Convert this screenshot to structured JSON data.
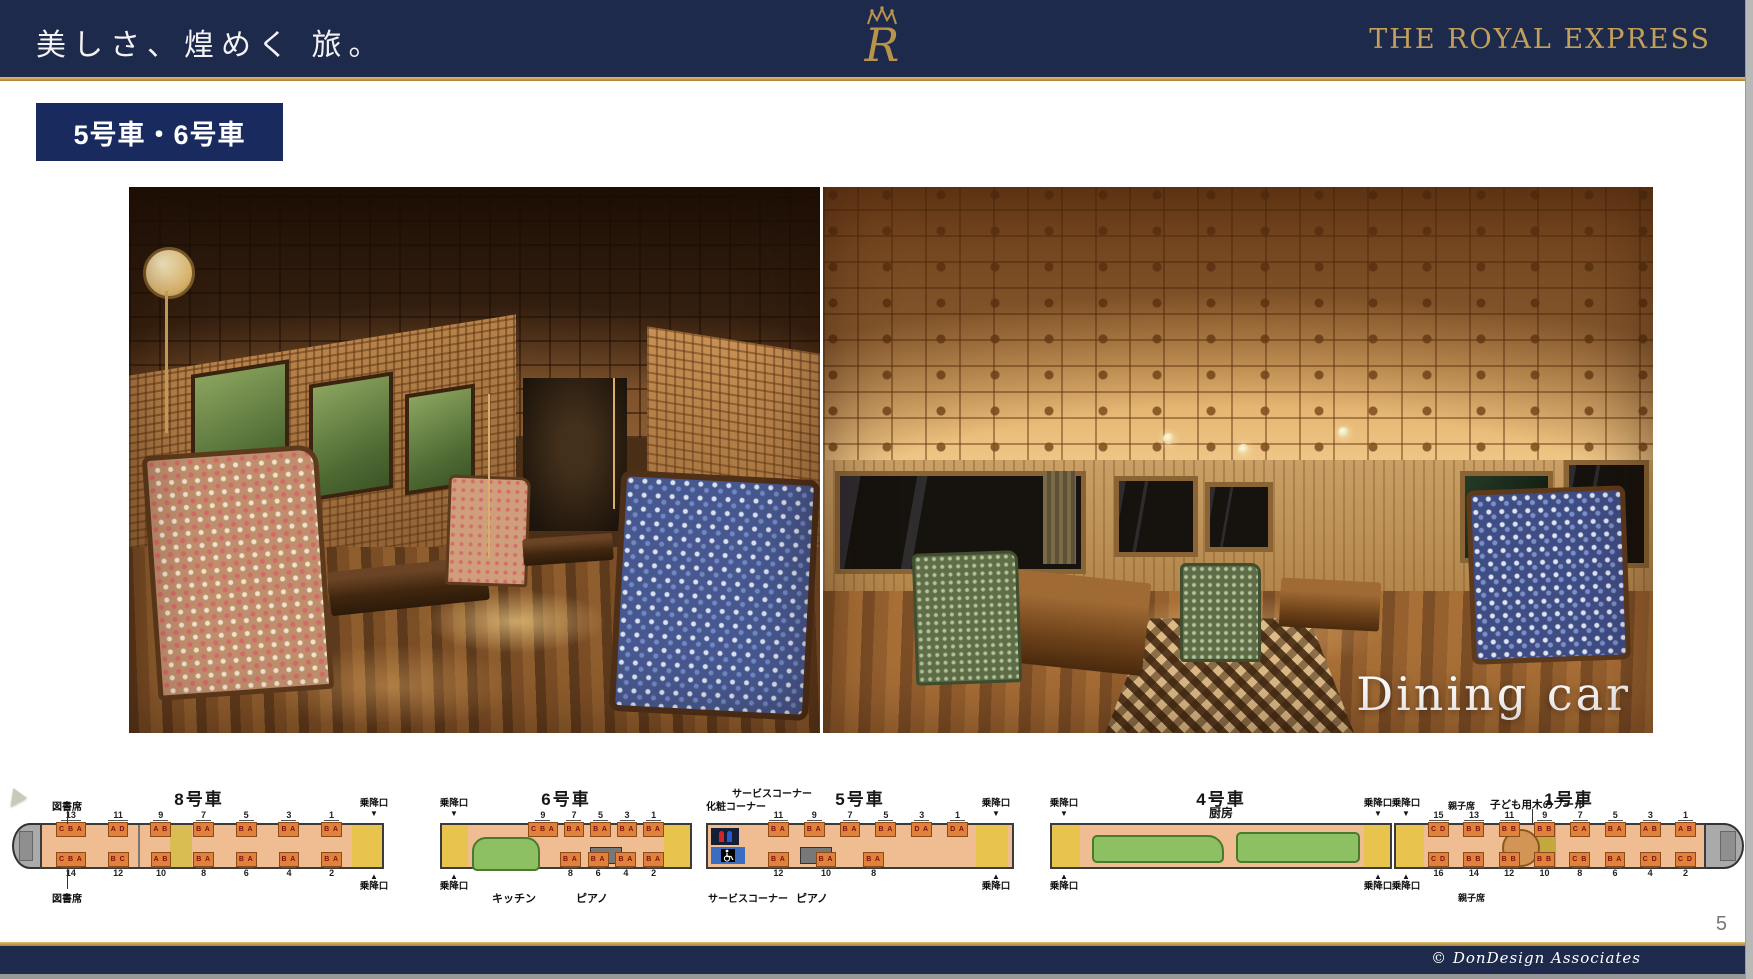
{
  "header": {
    "tagline": "美しさ、煌めく 旅。",
    "brand": "THE ROYAL EXPRESS",
    "logo": "crown-r-monogram"
  },
  "slide": {
    "badge": "5号車・6号車",
    "photos": [
      {
        "name": "lounge-car-interior-photo"
      },
      {
        "name": "dining-car-interior-photo",
        "caption": "Dining car"
      }
    ],
    "page_number": "5"
  },
  "footer": {
    "credit": "© DonDesign Associates"
  },
  "diagram": {
    "door_label": "乗降口",
    "arrow_down": "▼",
    "arrow_up": "▲",
    "cars": [
      {
        "title": "8号車",
        "library_label_top": "図書席",
        "library_label_bottom": "図書席",
        "top_groups": [
          {
            "n": "13",
            "s": "C B A"
          },
          {
            "n": "11",
            "s": "A D"
          },
          {
            "n": "9",
            "s": "A B"
          },
          {
            "n": "7",
            "s": "B A"
          },
          {
            "n": "5",
            "s": "B A"
          },
          {
            "n": "3",
            "s": "B A"
          },
          {
            "n": "1",
            "s": "B A"
          }
        ],
        "bottom_groups": [
          {
            "n": "14",
            "s": "C B A"
          },
          {
            "n": "12",
            "s": "B C"
          },
          {
            "n": "10",
            "s": "A B"
          },
          {
            "n": "8",
            "s": "B A"
          },
          {
            "n": "6",
            "s": "B A"
          },
          {
            "n": "4",
            "s": "B A"
          },
          {
            "n": "2",
            "s": "B A"
          }
        ]
      },
      {
        "title": "6号車",
        "kitchen_label": "キッチン",
        "piano_label": "ピアノ",
        "top_groups": [
          {
            "n": "9",
            "s": "C B A"
          },
          {
            "n": "7",
            "s": "B A"
          },
          {
            "n": "5",
            "s": "B A"
          },
          {
            "n": "3",
            "s": "B A"
          },
          {
            "n": "1",
            "s": "B A"
          }
        ],
        "bottom_groups": [
          {
            "n": "8",
            "s": "B A"
          },
          {
            "n": "6",
            "s": "B A"
          },
          {
            "n": "4",
            "s": "B A"
          },
          {
            "n": "2",
            "s": "B A"
          }
        ]
      },
      {
        "title": "5号車",
        "service_label_top": "サービスコーナー",
        "makeup_label": "化粧コーナー",
        "service_label_bottom": "サービスコーナー",
        "piano_label": "ピアノ",
        "icons": [
          "restroom-icon",
          "wheelchair-icon"
        ],
        "top_groups": [
          {
            "n": "11",
            "s": "B A"
          },
          {
            "n": "9",
            "s": "B A"
          },
          {
            "n": "7",
            "s": "B A"
          },
          {
            "n": "5",
            "s": "B A"
          },
          {
            "n": "3",
            "s": "D A"
          },
          {
            "n": "1",
            "s": "D A"
          }
        ],
        "bottom_groups": [
          {
            "n": "12",
            "s": "B A"
          },
          {
            "n": "10",
            "s": "B A"
          },
          {
            "n": "8",
            "s": "B A"
          }
        ]
      },
      {
        "title": "4号車",
        "subtitle": "厨房"
      },
      {
        "title": "1号車",
        "oyako_label_top": "親子席",
        "pool_label": "子ども用木のプール",
        "oyako_label_bottom": "親子席",
        "top_groups": [
          {
            "n": "15",
            "s": "C D"
          },
          {
            "n": "13",
            "s": "B B"
          },
          {
            "n": "11",
            "s": "B B"
          },
          {
            "n": "9",
            "s": "B B"
          },
          {
            "n": "7",
            "s": "C A"
          },
          {
            "n": "5",
            "s": "B A"
          },
          {
            "n": "3",
            "s": "A B"
          },
          {
            "n": "1",
            "s": "A B"
          }
        ],
        "bottom_groups": [
          {
            "n": "16",
            "s": "C D"
          },
          {
            "n": "14",
            "s": "B B"
          },
          {
            "n": "12",
            "s": "B B"
          },
          {
            "n": "10",
            "s": "B B"
          },
          {
            "n": "8",
            "s": "C B"
          },
          {
            "n": "6",
            "s": "B A"
          },
          {
            "n": "4",
            "s": "C D"
          },
          {
            "n": "2",
            "s": "C D"
          }
        ]
      }
    ]
  },
  "colors": {
    "header_navy": "#1e2a4c",
    "badge_navy": "#182a5e",
    "gold": "#c09c4f",
    "brand_gold": "#c2a05a",
    "floor_salmon": "#f0bd93",
    "seat_orange": "#e0813c",
    "door_yellow": "#e8c44e",
    "kitchen_green": "#8cc063"
  }
}
